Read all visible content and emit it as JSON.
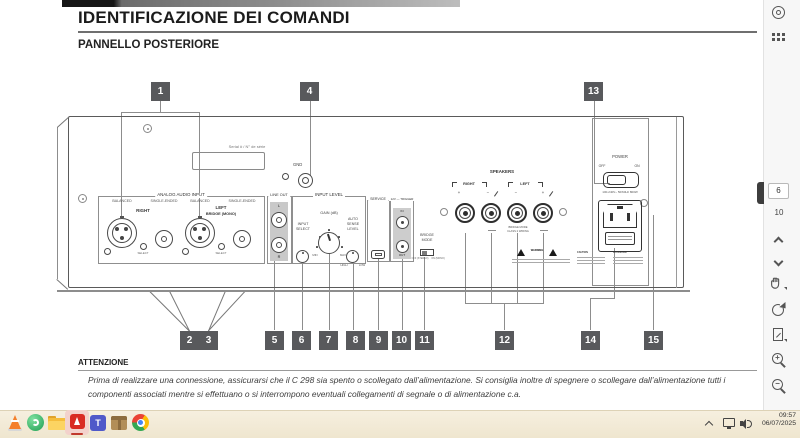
{
  "page": {
    "title": "IDENTIFICAZIONE DEI COMANDI",
    "subtitle": "PANNELLO POSTERIORE",
    "attention_heading": "ATTENZIONE",
    "attention_body": "Prima di realizzare una connessione, assicurarsi che il C 298 sia spento o scollegato dall’alimentazione. Si consiglia inoltre di spegnere o scollegare dall’alimentazione tutti i componenti associati mentre si effettuano o si interrompono eventuali collegamenti di segnale o di alimentazione c.a."
  },
  "diagram": {
    "callouts": {
      "c1": "1",
      "c2": "2",
      "c3": "3",
      "c4": "4",
      "c5": "5",
      "c6": "6",
      "c7": "7",
      "c8": "8",
      "c9": "9",
      "c10": "10",
      "c11": "11",
      "c12": "12",
      "c13": "13",
      "c14": "14",
      "c15": "15"
    },
    "labels": {
      "serial": "Serial # / N° de série",
      "gnd": "GND",
      "analog_audio_input": "ANALOG AUDIO INPUT",
      "balanced": "BALANCED",
      "single_ended": "SINGLE-ENDED",
      "right": "RIGHT",
      "left": "LEFT",
      "bridge_mono": "BRIDGE (MONO)",
      "select": "SELECT",
      "line_out": "LINE OUT",
      "l": "L",
      "r": "R",
      "input_level": "INPUT LEVEL",
      "input": "INPUT",
      "gain_db": "GAIN (dB)",
      "min": "MIN",
      "max": "MAX",
      "auto": "AUTO",
      "sense": "SENSE",
      "level": "LEVEL",
      "high": "HIGH",
      "low": "LOW",
      "service": "SERVICE",
      "trigger": "12V — TRIGGER",
      "in": "IN",
      "out": "OUT",
      "bridge": "BRIDGE",
      "mode": "MODE",
      "off_stereo": "OFF (STEREO)",
      "on_mono": "ON (MONO)",
      "speakers": "SPEAKERS",
      "plus": "+",
      "minus": "−",
      "bridge_mode_wiring": "BRIDGE MODE",
      "class2_wiring": "CLASS 2 WIRING",
      "warning": "WARNING",
      "caution": "CAUTION",
      "attention": "ATTENTION",
      "power": "POWER",
      "off": "OFF",
      "on": "ON",
      "rating": "100-240V~ 50/60Hz 800W"
    }
  },
  "sidebar": {
    "page_current": "6",
    "page_total": "10"
  },
  "taskbar": {
    "time": "09:57",
    "date": "06/07/2025",
    "apps": [
      "vlc",
      "green-app",
      "file-explorer",
      "acrobat",
      "teams",
      "package",
      "chrome"
    ]
  }
}
